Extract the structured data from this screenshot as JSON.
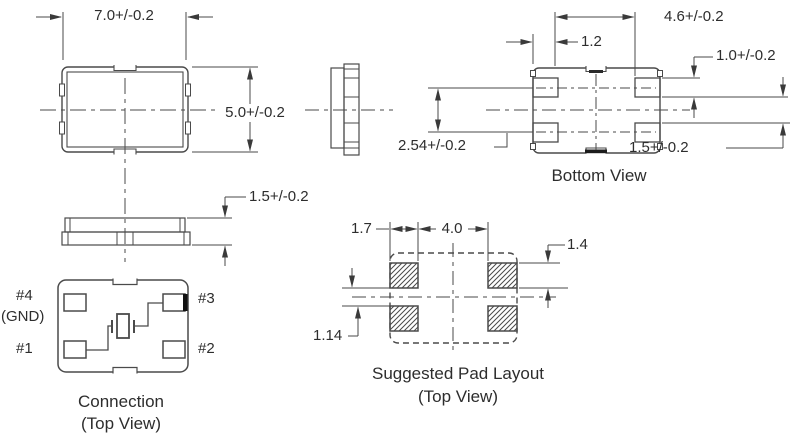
{
  "figure": {
    "background": "#ffffff",
    "line_color": "#4a4a4a",
    "text_color": "#2d2d2d",
    "accent_black": "#1c1c1c",
    "views": {
      "package_top": {
        "width_dim": "7.0+/-0.2",
        "height_dim": "5.0+/-0.2"
      },
      "package_front": {
        "thickness_dim": "1.5+/-0.2"
      },
      "bottom": {
        "title": "Bottom View",
        "pad_span_dim": "4.6+/-0.2",
        "edge_to_pad_dim": "1.2",
        "pad_width_dim": "1.0+/-0.2",
        "pad_pitch_dim": "2.54+/-0.2",
        "pad_gap_dim": "1.5+/-0.2"
      },
      "connection": {
        "title": "Connection",
        "subtitle": "(Top View)",
        "pin4_label": "#4",
        "pin4_note": "(GND)",
        "pin1_label": "#1",
        "pin3_label": "#3",
        "pin2_label": "#2"
      },
      "pad_layout": {
        "title": "Suggested Pad Layout",
        "subtitle": "(Top View)",
        "pad_width_dim": "1.7",
        "pad_gap_dim": "4.0",
        "pad_height_dim": "1.4",
        "row_gap_dim": "1.14"
      }
    }
  }
}
